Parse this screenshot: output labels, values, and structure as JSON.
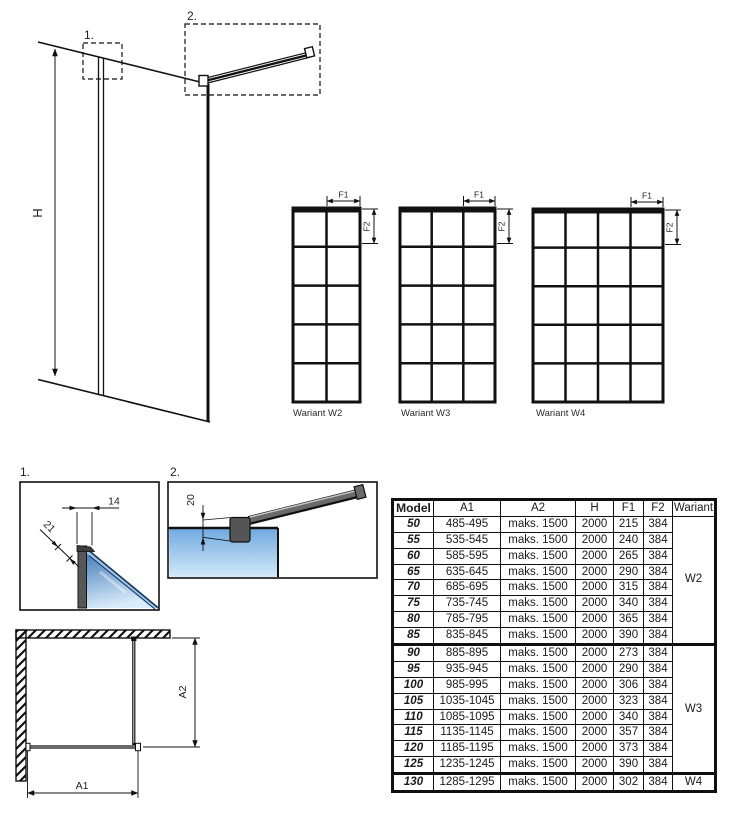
{
  "perspective": {
    "h_label": "H",
    "detail_refs": {
      "one": "1.",
      "two": "2."
    }
  },
  "variants": {
    "f1_label": "F1",
    "f2_label": "F2",
    "items": [
      {
        "label": "Wariant W2",
        "columns": 2,
        "rows": 5
      },
      {
        "label": "Wariant W3",
        "columns": 3,
        "rows": 5
      },
      {
        "label": "Wariant W4",
        "columns": 4,
        "rows": 5
      }
    ]
  },
  "details": {
    "detail1": {
      "label": "1.",
      "dim_width": "14",
      "dim_depth": "21"
    },
    "detail2": {
      "label": "2.",
      "dim_height": "20"
    }
  },
  "plan": {
    "a1_label": "A1",
    "a2_label": "A2"
  },
  "table": {
    "headers": [
      "Model",
      "A1",
      "A2",
      "H",
      "F1",
      "F2",
      "Wariant"
    ],
    "rows": [
      {
        "model": "50",
        "a1": "485-495",
        "a2": "maks. 1500",
        "h": "2000",
        "f1": "215",
        "f2": "384"
      },
      {
        "model": "55",
        "a1": "535-545",
        "a2": "maks. 1500",
        "h": "2000",
        "f1": "240",
        "f2": "384"
      },
      {
        "model": "60",
        "a1": "585-595",
        "a2": "maks. 1500",
        "h": "2000",
        "f1": "265",
        "f2": "384"
      },
      {
        "model": "65",
        "a1": "635-645",
        "a2": "maks. 1500",
        "h": "2000",
        "f1": "290",
        "f2": "384"
      },
      {
        "model": "70",
        "a1": "685-695",
        "a2": "maks. 1500",
        "h": "2000",
        "f1": "315",
        "f2": "384"
      },
      {
        "model": "75",
        "a1": "735-745",
        "a2": "maks. 1500",
        "h": "2000",
        "f1": "340",
        "f2": "384"
      },
      {
        "model": "80",
        "a1": "785-795",
        "a2": "maks. 1500",
        "h": "2000",
        "f1": "365",
        "f2": "384"
      },
      {
        "model": "85",
        "a1": "835-845",
        "a2": "maks. 1500",
        "h": "2000",
        "f1": "390",
        "f2": "384"
      },
      {
        "model": "90",
        "a1": "885-895",
        "a2": "maks. 1500",
        "h": "2000",
        "f1": "273",
        "f2": "384"
      },
      {
        "model": "95",
        "a1": "935-945",
        "a2": "maks. 1500",
        "h": "2000",
        "f1": "290",
        "f2": "384"
      },
      {
        "model": "100",
        "a1": "985-995",
        "a2": "maks. 1500",
        "h": "2000",
        "f1": "306",
        "f2": "384"
      },
      {
        "model": "105",
        "a1": "1035-1045",
        "a2": "maks. 1500",
        "h": "2000",
        "f1": "323",
        "f2": "384"
      },
      {
        "model": "110",
        "a1": "1085-1095",
        "a2": "maks. 1500",
        "h": "2000",
        "f1": "340",
        "f2": "384"
      },
      {
        "model": "115",
        "a1": "1135-1145",
        "a2": "maks. 1500",
        "h": "2000",
        "f1": "357",
        "f2": "384"
      },
      {
        "model": "120",
        "a1": "1185-1195",
        "a2": "maks. 1500",
        "h": "2000",
        "f1": "373",
        "f2": "384"
      },
      {
        "model": "125",
        "a1": "1235-1245",
        "a2": "maks. 1500",
        "h": "2000",
        "f1": "390",
        "f2": "384"
      },
      {
        "model": "130",
        "a1": "1285-1295",
        "a2": "maks. 1500",
        "h": "2000",
        "f1": "302",
        "f2": "384"
      }
    ],
    "groups": [
      {
        "label": "W2",
        "span": 8
      },
      {
        "label": "W3",
        "span": 8
      },
      {
        "label": "W4",
        "span": 1
      }
    ]
  },
  "colors": {
    "line_black": "#111111",
    "glass_blue_dark": "#4179b8",
    "glass_blue_light": "#d9ecfa",
    "glass_edge_navy": "#16355c",
    "profile_gray": "#575757",
    "bar_top_gray": "#c8c8c8"
  }
}
